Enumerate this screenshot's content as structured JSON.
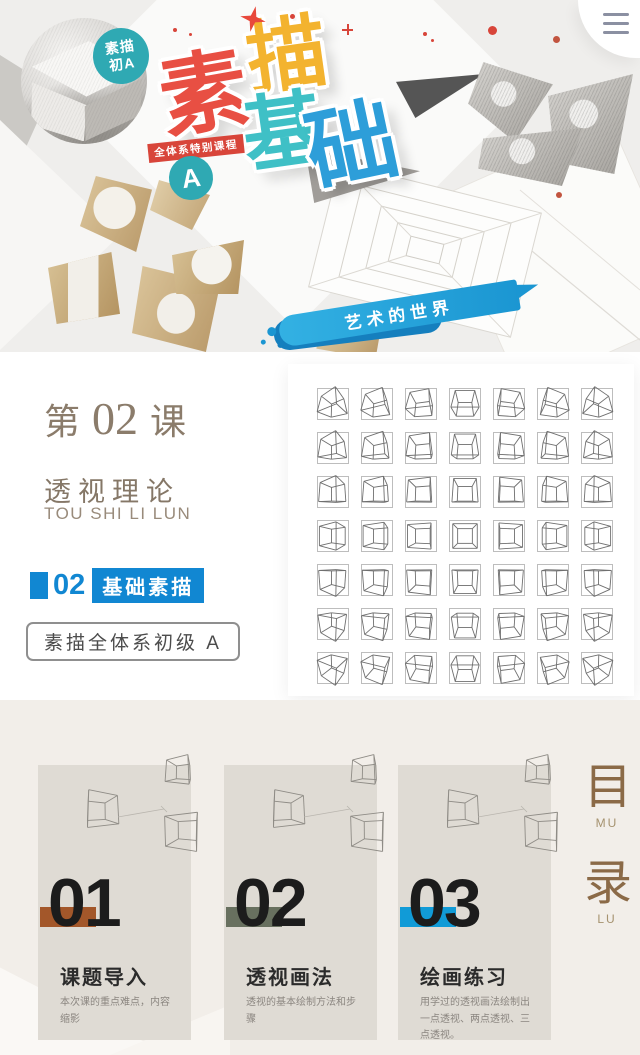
{
  "colors": {
    "title_red": "#e84f43",
    "title_orange": "#f3b32f",
    "title_teal": "#3fc0c6",
    "title_blue": "#2d9ed9",
    "badge_teal": "#2fa9b3",
    "banner_blue": "#1b96d2",
    "tag_blue": "#1187d2",
    "lesson_brown": "#8b7c6b",
    "toc_brown": "#8b6a47",
    "accent_1": "#a3572a",
    "accent_2": "#68705f",
    "accent_3": "#119bd7"
  },
  "hero": {
    "photo_badge": {
      "line1": "素描",
      "line2": "初A"
    },
    "title": [
      {
        "char": "素"
      },
      {
        "char": "描"
      },
      {
        "char": "基"
      },
      {
        "char": "础"
      }
    ],
    "series_ribbon": "全体系特别课程",
    "grade_badge": "A",
    "banner": "艺术的世界"
  },
  "lesson": {
    "prefix": "第",
    "number": "02",
    "suffix": "课",
    "topic": "透视理论",
    "pinyin": "TOU SHI LI LUN",
    "tag_number": "02",
    "tag_label": "基础素描",
    "series_box": "素描全体系初级 A"
  },
  "cube_grid": {
    "rows": 7,
    "cols": 7
  },
  "toc": {
    "side_labels": [
      {
        "char": "目",
        "pinyin": "MU"
      },
      {
        "char": "录",
        "pinyin": "LU"
      }
    ],
    "items": [
      {
        "number": "01",
        "title": "课题导入",
        "desc": "本次课的重点难点，内容缩影"
      },
      {
        "number": "02",
        "title": "透视画法",
        "desc": "透视的基本绘制方法和步骤"
      },
      {
        "number": "03",
        "title": "绘画练习",
        "desc": "用学过的透视画法绘制出一点透视、两点透视、三点透视。"
      }
    ]
  }
}
